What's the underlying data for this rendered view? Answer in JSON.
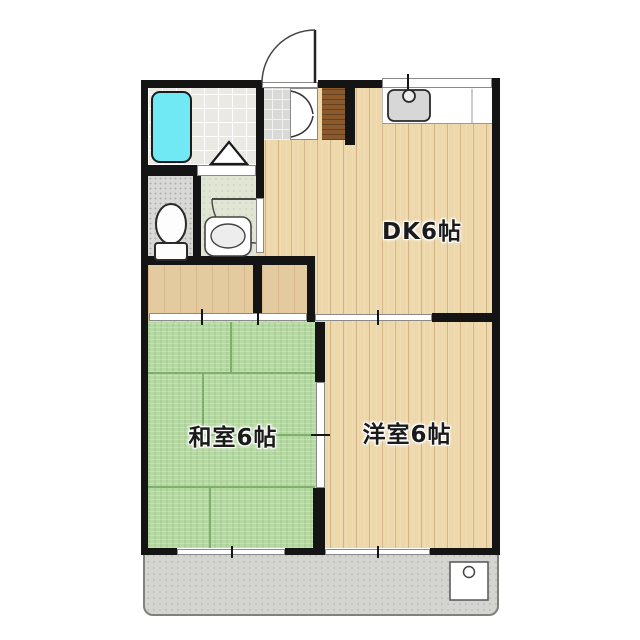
{
  "plan_title": "apartment-floor-plan",
  "rooms": {
    "dk": {
      "label": "DK6帖"
    },
    "japanese_room": {
      "label": "和室6帖"
    },
    "western_room": {
      "label": "洋室6帖"
    }
  },
  "fixtures": [
    "bathtub",
    "shower-tile-floor",
    "toilet",
    "wash-basin",
    "kitchen-sink",
    "kitchen-counter",
    "kitchen-window",
    "entrance-door",
    "shoe-cabinet",
    "genkan-step",
    "closet",
    "sliding-doors",
    "balcony",
    "washer-pan",
    "windows"
  ],
  "colors": {
    "wall": "#141414",
    "wood_floor": "#eed7a9",
    "tatami": "#b6d9a3",
    "bathtub": "#70e9f4",
    "step_wood": "#8a5a2c",
    "closet": "#e4ca9f",
    "balcony": "#d4d4d0",
    "washroom_floor": "#e1e5d3",
    "bath_tile": "#ebe9e3",
    "toilet_floor": "#d8d8d6"
  }
}
